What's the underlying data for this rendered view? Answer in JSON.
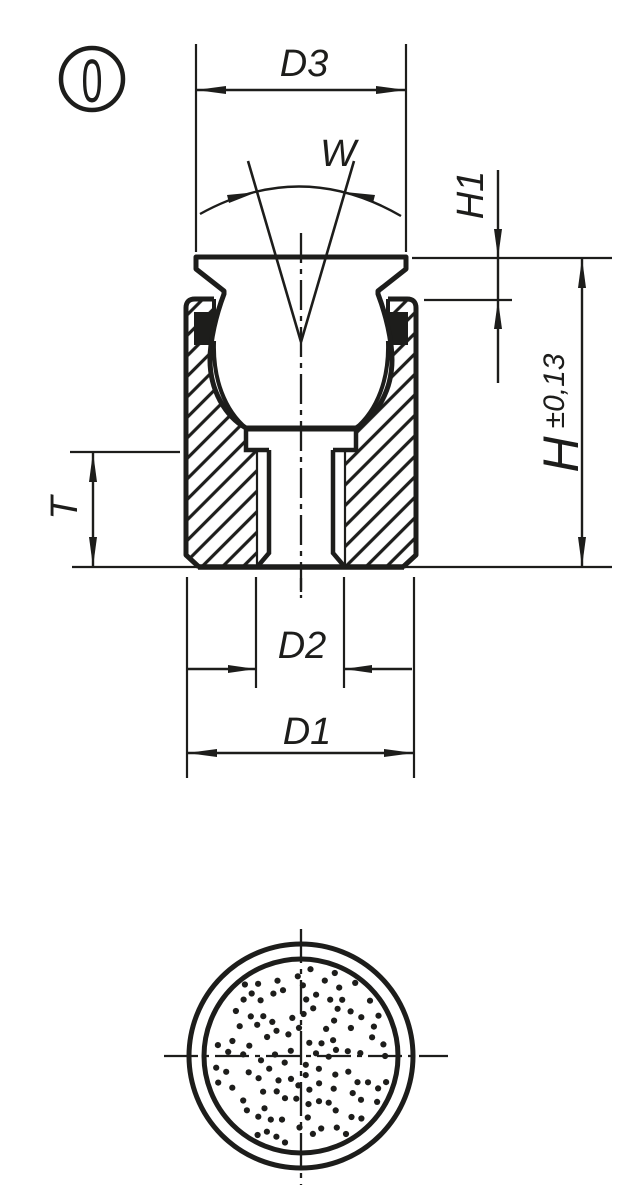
{
  "page": {
    "background": "#ffffff"
  },
  "drawing": {
    "type": "technical-section-drawing",
    "marker_label": "0",
    "labels": {
      "d3": "D3",
      "w": "W",
      "h1": "H1",
      "h": "H",
      "h_tol": "±0,13",
      "t": "T",
      "d2": "D2",
      "d1": "D1"
    },
    "line_color": "#1d1d1b",
    "background_color": "#ffffff"
  }
}
